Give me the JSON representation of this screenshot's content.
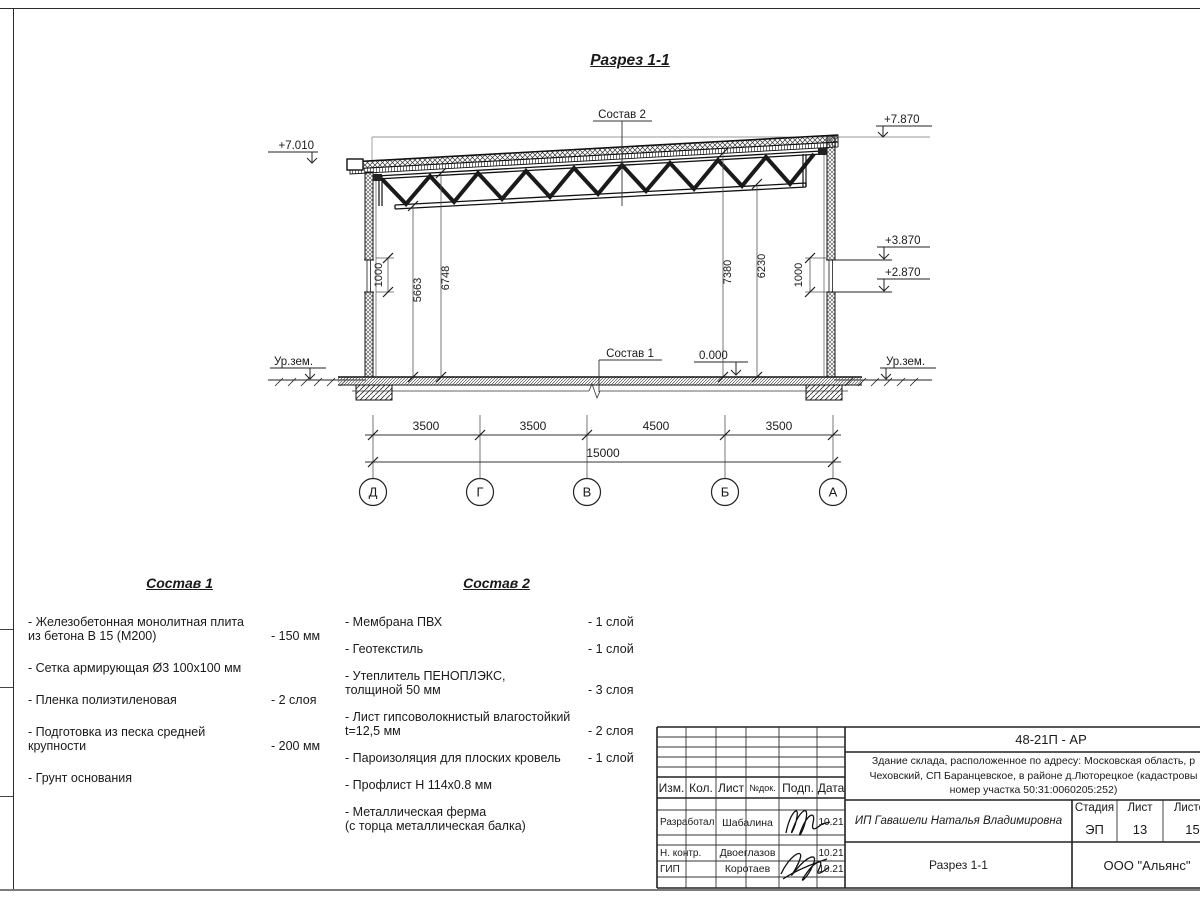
{
  "sheet": {
    "title": "Разрез 1-1"
  },
  "drawing": {
    "elevation_marks": {
      "left_top": "+7.010",
      "right_top": "+7.870",
      "right_window_top": "+3.870",
      "right_window_bottom": "+2.870",
      "floor_zero": "0.000",
      "ground_left": "Ур.зем.",
      "ground_right": "Ур.зем."
    },
    "callouts": {
      "roof": "Состав 2",
      "floor": "Состав 1"
    },
    "heights": {
      "left_window": "1000",
      "h1": "5663",
      "h2": "6748",
      "h3": "7380",
      "h4": "6230",
      "right_window": "1000"
    },
    "spans": [
      "3500",
      "3500",
      "4500",
      "3500"
    ],
    "total_span": "15000",
    "axes": [
      "Д",
      "Г",
      "В",
      "Б",
      "А"
    ]
  },
  "sostav1": {
    "heading": "Состав 1",
    "items": [
      {
        "name": "- Железобетонная  монолитная плита\n  из бетона В 15 (М200)",
        "value": "- 150 мм"
      },
      {
        "name": "- Сетка армирующая Ø3 100х100 мм",
        "value": ""
      },
      {
        "name": "- Пленка полиэтиленовая",
        "value": "-  2 слоя"
      },
      {
        "name": "- Подготовка из песка средней\n  крупности",
        "value": "- 200 мм"
      },
      {
        "name": "- Грунт основания",
        "value": ""
      }
    ]
  },
  "sostav2": {
    "heading": "Состав 2",
    "items": [
      {
        "name": "- Мембрана ПВХ",
        "value": "- 1 слой"
      },
      {
        "name": "- Геотекстиль",
        "value": "- 1 слой"
      },
      {
        "name": "- Утеплитель ПЕНОПЛЭКС,\n  толщиной 50 мм",
        "value": "- 3 слоя"
      },
      {
        "name": "- Лист гипсоволокнистый влагостойкий\n t=12,5 мм",
        "value": "- 2 слоя"
      },
      {
        "name": "- Пароизоляция для плоских кровель",
        "value": "- 1 слой"
      },
      {
        "name": "- Профлист Н 114х0.8 мм",
        "value": ""
      },
      {
        "name": "- Металлическая ферма\n  (с торца металлическая балка)",
        "value": ""
      }
    ]
  },
  "titleblock": {
    "code": "48-21П - АР",
    "object": "Здание склада, расположенное по адресу: Московская область, р\nЧеховский, СП Баранцевское, в районе д.Люторецкое  (кадастровы\nномер участка 50:31:0060205:252)",
    "cols": {
      "izm": "Изм.",
      "kol": "Кол.",
      "list": "Лист",
      "ndok": "№док.",
      "podp": "Подп.",
      "data": "Дата"
    },
    "rows": [
      {
        "role": "Разработал",
        "name": "Шабалина",
        "date": "10.21"
      },
      {
        "role": "Н. контр.",
        "name": "Двоеглазов",
        "date": "10.21"
      },
      {
        "role": "ГИП",
        "name": "Коротаев",
        "date": "10.21"
      }
    ],
    "client": "ИП Гавашели Наталья Владимировна",
    "stage_label": "Стадия",
    "sheet_label": "Лист",
    "sheets_label": "Листов",
    "stage": "ЭП",
    "sheet_num": "13",
    "sheets_total": "15",
    "section_name": "Разрез 1-1",
    "company": "ООО \"Альянс\""
  }
}
